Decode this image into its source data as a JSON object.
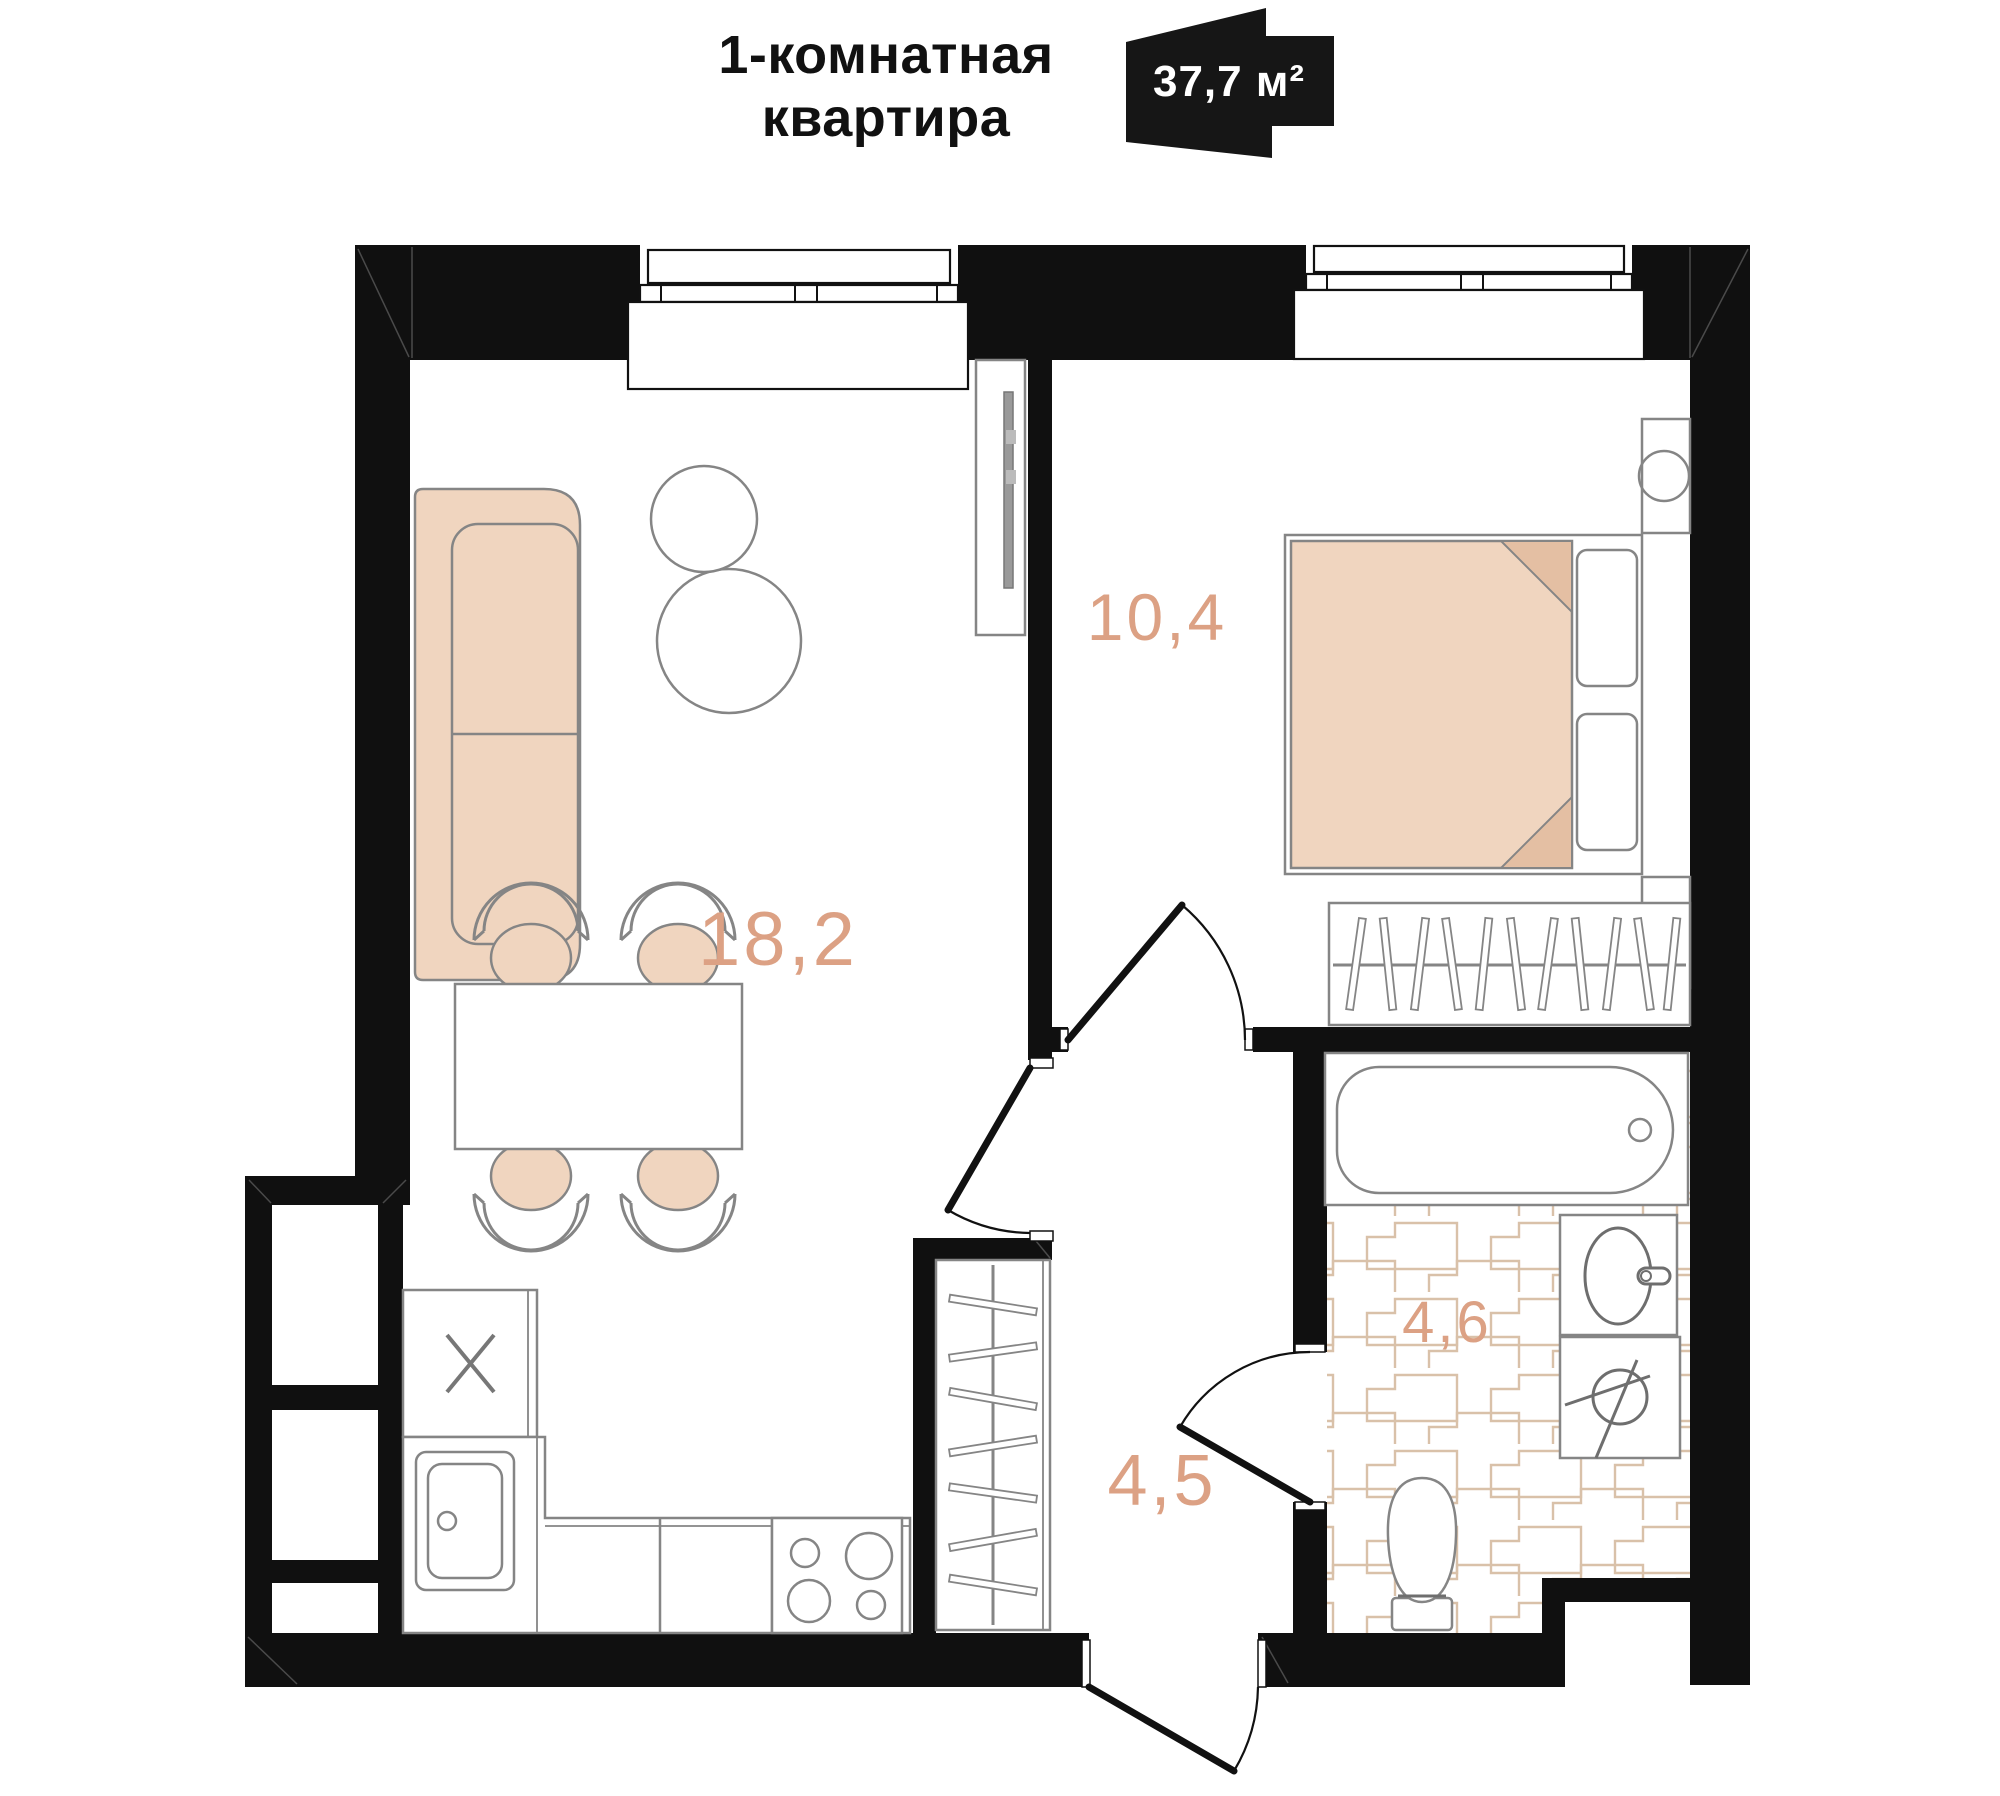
{
  "header": {
    "title_line1": "1-комнатная",
    "title_line2": "квартира",
    "area_badge": "37,7 м²"
  },
  "plan": {
    "rooms": [
      {
        "id": "living-kitchen",
        "name": "кухня-гостиная",
        "area": "18,2"
      },
      {
        "id": "bedroom",
        "name": "спальня",
        "area": "10,4"
      },
      {
        "id": "hallway",
        "name": "прихожая",
        "area": "4,5"
      },
      {
        "id": "bathroom",
        "name": "санузел",
        "area": "4,6"
      }
    ],
    "colors": {
      "wall": "#101010",
      "furn": "#f0d5bf",
      "furn_dark": "#e4bfa3",
      "stroke": "#858585",
      "label": "#dca184",
      "tile": "#d9c1a9",
      "text": "#111111"
    }
  }
}
